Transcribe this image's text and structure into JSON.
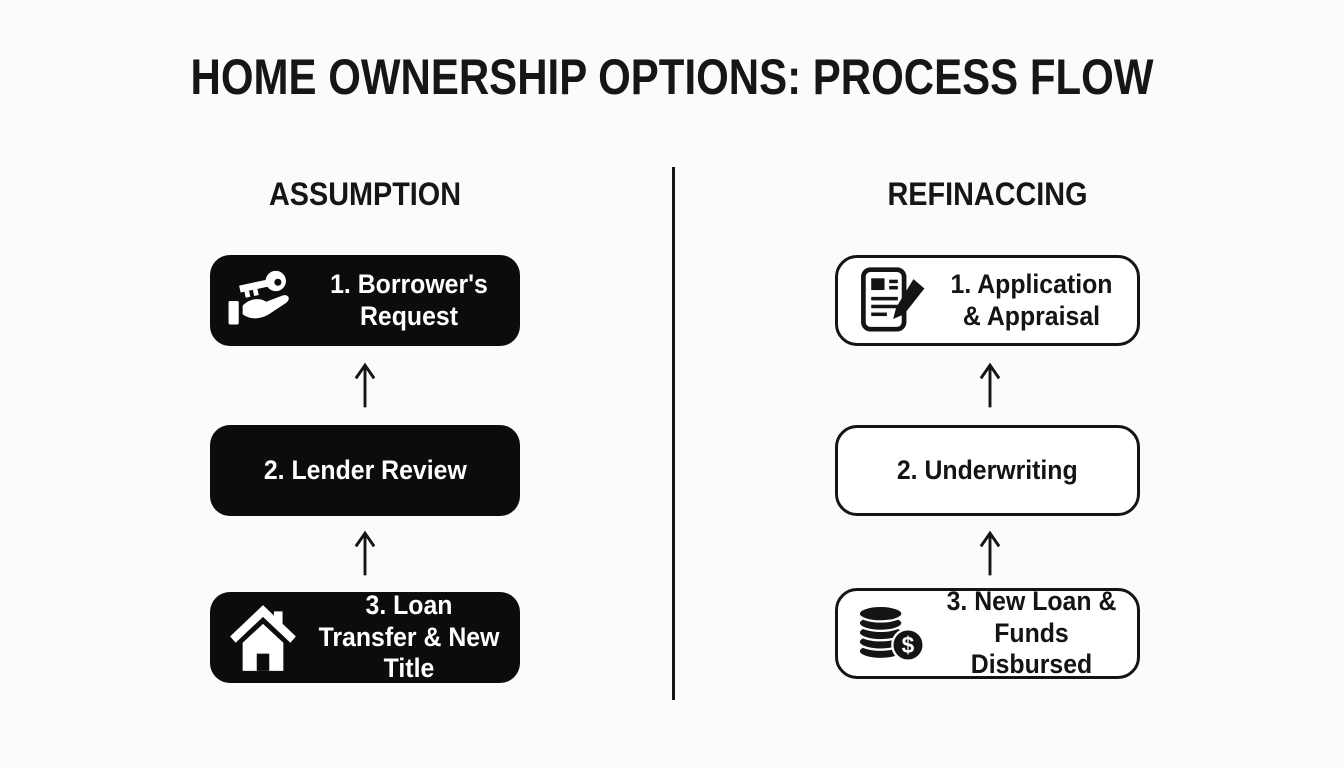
{
  "title": "HOME OWNERSHIP OPTIONS: PROCESS FLOW",
  "colors": {
    "background": "#fbfbfb",
    "ink": "#141414",
    "box_fill": "#0c0c0c",
    "box_text_light": "#ffffff"
  },
  "icons": {
    "dollar_glyph": "$"
  },
  "columns": [
    {
      "header": "ASSUMPTION",
      "box_style": "filled",
      "steps": [
        {
          "label": "1. Borrower's Request",
          "icon": "hand-key-icon"
        },
        {
          "label": "2. Lender Review",
          "icon": ""
        },
        {
          "label": "3. Loan Transfer & New Title",
          "icon": "house-icon"
        }
      ]
    },
    {
      "header": "REFINACCING",
      "box_style": "outline",
      "steps": [
        {
          "label": "1. Application & Appraisal",
          "icon": "document-pencil-icon"
        },
        {
          "label": "2. Underwriting",
          "icon": ""
        },
        {
          "label": "3. New Loan & Funds Disbursed",
          "icon": "coins-dollar-icon"
        }
      ]
    }
  ]
}
